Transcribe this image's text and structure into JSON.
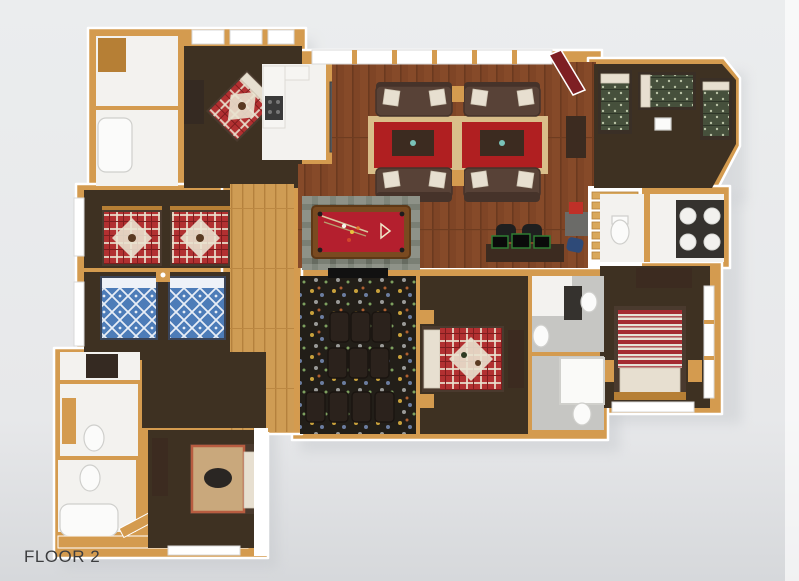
{
  "floorplan": {
    "floor_label": "FLOOR 2",
    "style": "3d-rendered overhead floor plan, log-cabin lodge",
    "rooms": [
      {
        "id": "living-room",
        "name": "Great room with two sofa seating groups on red oriental rugs",
        "floor": "wood planks"
      },
      {
        "id": "kitchenette",
        "name": "Kitchenette with white counters, stove and gray bar counter",
        "floor": "white tile"
      },
      {
        "id": "billiards-area",
        "name": "Billiards area with red-felt pool table on gray plaid rug",
        "floor": "wood planks"
      },
      {
        "id": "computer-nook",
        "name": "Computer desk with two black chairs and monitors",
        "floor": "wood planks"
      },
      {
        "id": "bunk-room",
        "name": "Bunk room with three green-quilt beds",
        "floor": "dark brown carpet"
      },
      {
        "id": "bedroom-top-left",
        "name": "Bedroom with diagonal red plaid bed and dark dresser",
        "floor": "dark brown carpet"
      },
      {
        "id": "bedroom-twin-red",
        "name": "Bedroom with two red plaid moose twin beds",
        "floor": "dark brown carpet"
      },
      {
        "id": "bedroom-twin-blue",
        "name": "Bedroom with two blue patterned twin beds",
        "floor": "dark brown carpet"
      },
      {
        "id": "theater-room",
        "name": "Home theater with three rows of recliners on patterned carpet",
        "floor": "dark patterned carpet"
      },
      {
        "id": "bedroom-center",
        "name": "Bedroom with red plaid moose quilt bed and media dresser",
        "floor": "dark brown carpet"
      },
      {
        "id": "bedroom-right",
        "name": "Bedroom with red-and-white striped bed and windows",
        "floor": "dark brown carpet"
      },
      {
        "id": "bedroom-bottom",
        "name": "Bedroom with bear-motif quilt bed and dresser",
        "floor": "dark brown carpet"
      },
      {
        "id": "bathroom-double-vanity",
        "name": "Bathroom with dark double vanity and round sinks",
        "floor": "white tile"
      },
      {
        "id": "bathroom-top-left",
        "name": "Bathroom and closet with tub",
        "floor": "white tile"
      },
      {
        "id": "bathroom-left-upper",
        "name": "Bathroom with toilet",
        "floor": "white tile"
      },
      {
        "id": "bathroom-left-lower",
        "name": "Bathroom with toilet and tub",
        "floor": "white tile"
      },
      {
        "id": "bathroom-center-upper",
        "name": "Bathroom with toilet and vanity",
        "floor": "gray tile"
      },
      {
        "id": "bathroom-center-lower",
        "name": "Bathroom with shower and toilet",
        "floor": "gray tile"
      },
      {
        "id": "hallway",
        "name": "Hallway",
        "floor": "light wood planks"
      },
      {
        "id": "staircase",
        "name": "Wood staircase with red runner landing",
        "floor": "wood"
      }
    ],
    "furniture": [
      "sofa",
      "oriental-rug",
      "coffee-table",
      "side-table",
      "pool-table",
      "plaid-rug",
      "desk",
      "office-chair",
      "monitor",
      "recliner-seat",
      "movie-screen",
      "bed",
      "twin-bed",
      "bunk-bed",
      "dresser",
      "nightstand",
      "toilet",
      "bathtub",
      "shower",
      "vanity-sink",
      "kitchen-counter",
      "stove",
      "bar-counter",
      "stairs"
    ]
  },
  "palette": {
    "bg_top": "#ebedee",
    "bg_bottom": "#d6d8db",
    "wall_wood": "#d49b4f",
    "wall_wood_dark": "#b67f35",
    "wall_trim": "#ffffff",
    "wood_floor": "#7f4526",
    "wood_floor_line": "#6b3a1f",
    "hall_wood": "#cf9c54",
    "hall_wood_line": "#b5813d",
    "carpet_dark": "#3e3122",
    "tile_white": "#f3f2ef",
    "tile_gray": "#c6c6c3",
    "rug_red": "#b01f21",
    "rug_border": "#d9be8a",
    "rug_plaid": "#8e9288",
    "pool_felt": "#b41f2e",
    "sofa_brown": "#584237",
    "sofa_dark": "#46332a",
    "pillow_cream": "#e7dfd0",
    "table_dark": "#3c2b20",
    "theater_carpet": "#221e18",
    "seat_dark": "#2b221c",
    "quilt_red": "#b23031",
    "quilt_cream": "#e9e2cf",
    "quilt_blue": "#4d7cb8",
    "quilt_green": "#46503c",
    "stripe_red": "#a42b32",
    "bear_quilt": "#c9a87c",
    "bear_border": "#b85c40",
    "dresser_dark": "#352a22",
    "runner_red": "#7e1f23",
    "stair_wood": "#d9a85c",
    "counter_white": "#f6f5f2",
    "counter_gray": "#55575a",
    "screen_green": "#2e7d32",
    "chair_black": "#1f1f1f",
    "chair_blue": "#2e4a78",
    "box_red": "#c03028",
    "fixture_white": "#fbfbfa",
    "label_color": "#3c3d3f",
    "shadow": "#c4c7cb"
  }
}
